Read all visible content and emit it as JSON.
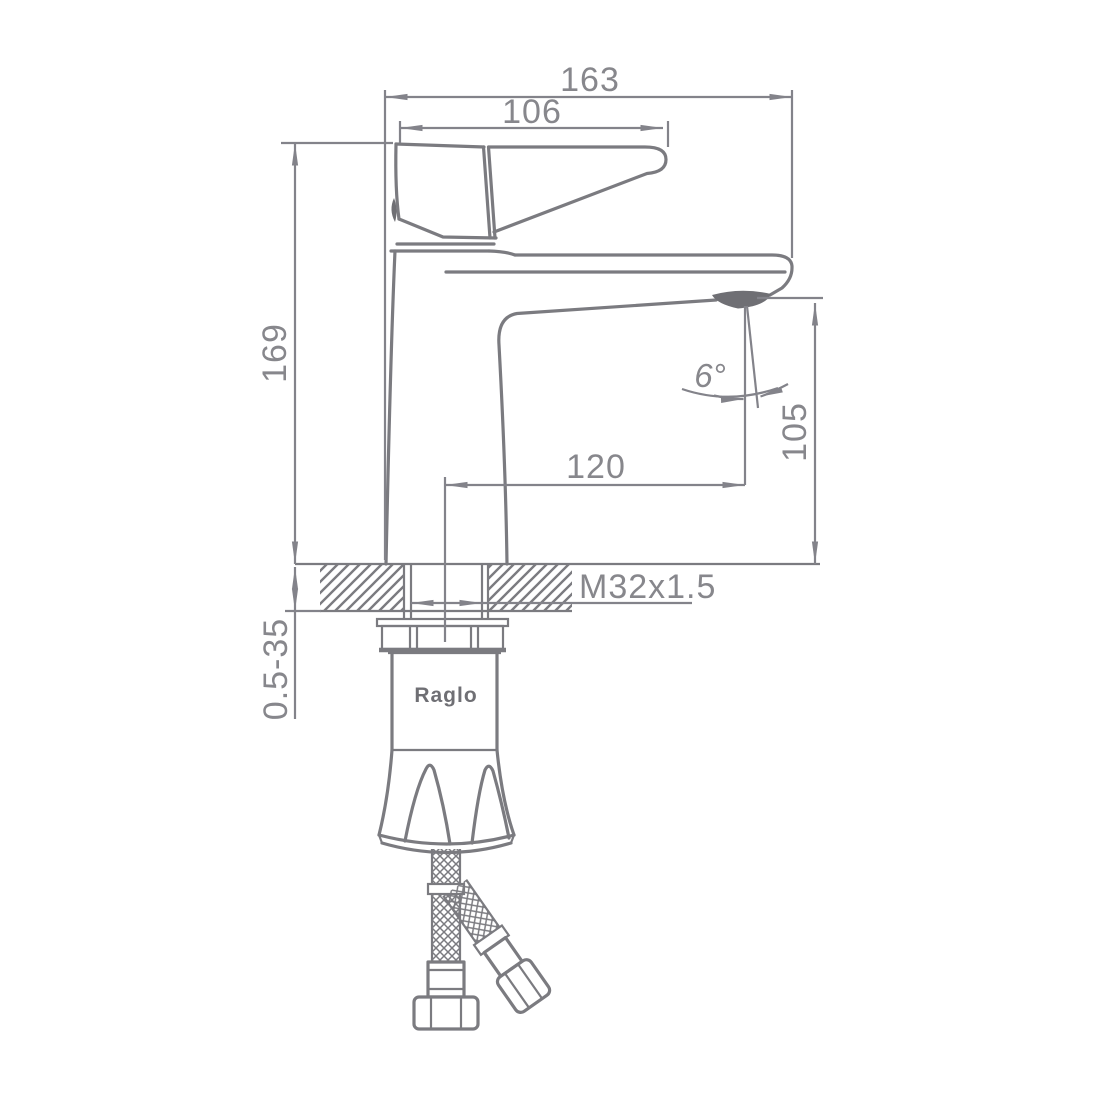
{
  "drawing": {
    "kind": "faucet installation technical drawing, side view",
    "brand": "Raglo",
    "dimensions": {
      "overall_length": "163",
      "handle_length": "106",
      "total_height": "169",
      "spout_height": "105",
      "spout_reach": "120",
      "spout_angle": "6°",
      "mounting_thread": "M32x1.5",
      "deck_thickness_range": "0.5-35"
    },
    "colors": {
      "line": "#7b7b80",
      "dimension_text": "#87878c",
      "dark_fill": "#6f6f74",
      "background": "#ffffff"
    }
  }
}
